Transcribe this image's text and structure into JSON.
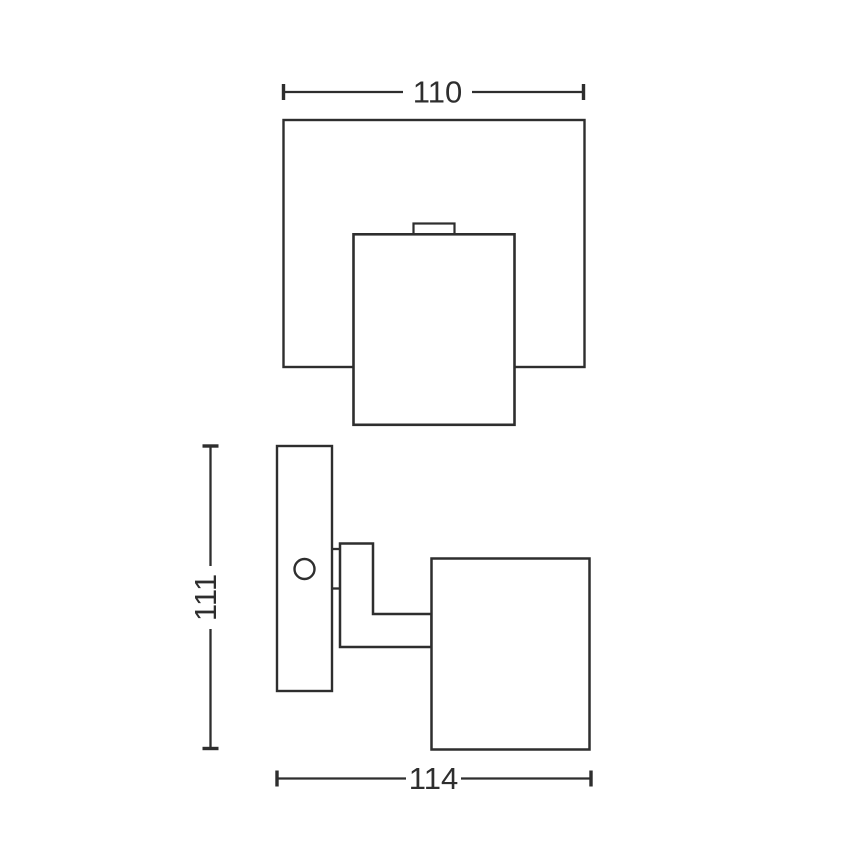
{
  "drawing": {
    "description": "wall-spotlight-dimension-drawing",
    "views": {
      "top_view": {
        "name": "top view",
        "width_dimension": {
          "label": "110",
          "orientation": "horizontal"
        }
      },
      "side_view": {
        "name": "side view",
        "height_dimension": {
          "label": "111",
          "orientation": "vertical"
        },
        "depth_dimension": {
          "label": "114",
          "orientation": "horizontal"
        }
      }
    }
  },
  "colors": {
    "line": "#2e2e2e",
    "background": "#ffffff"
  }
}
